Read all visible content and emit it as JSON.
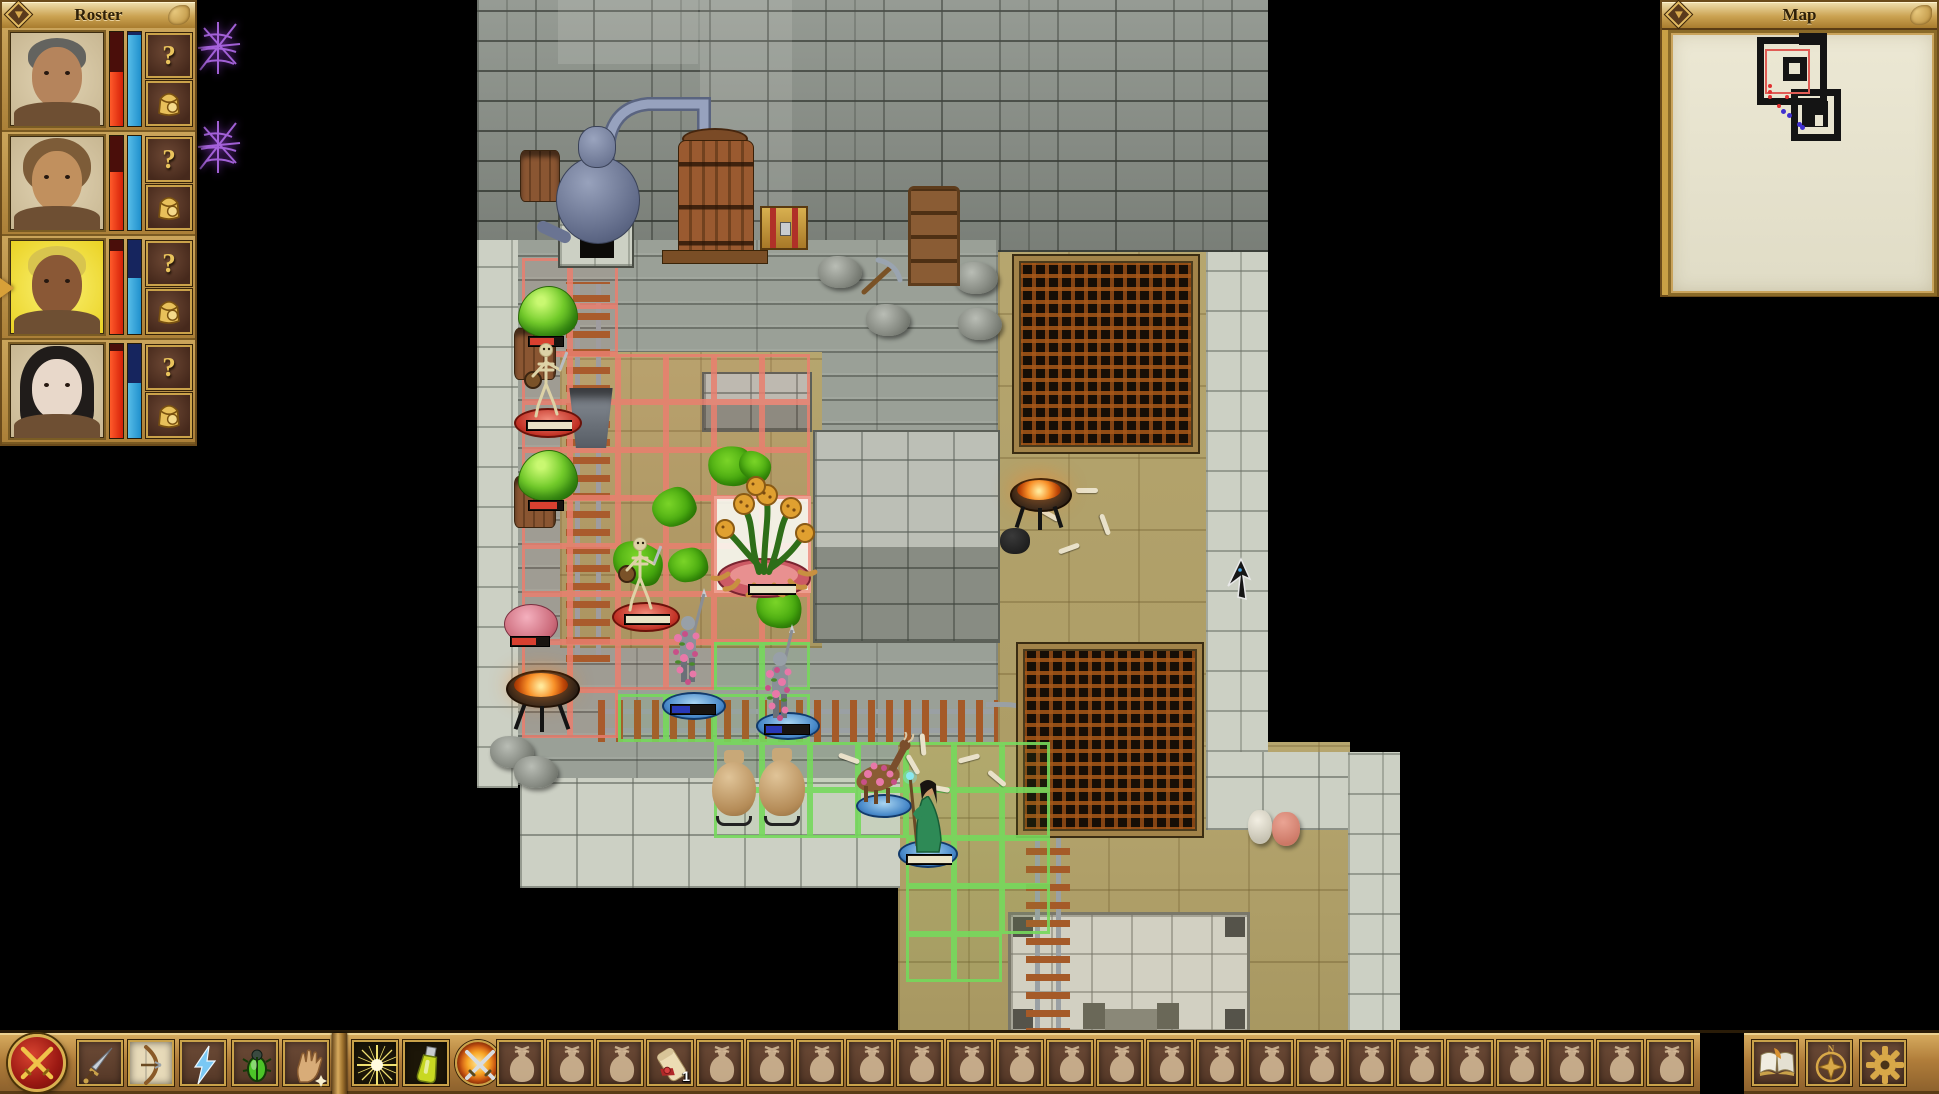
{
  "colors": {
    "accent_gold": "#c9a24a",
    "panel_wood": "#b8924a",
    "hp_red": "#e83416",
    "sp_blue": "#2e9fd6",
    "threat_red": "#e97f6f",
    "move_green": "#76d85c",
    "selected_slot": "#e7dab9"
  },
  "roster": {
    "title": "Roster",
    "collapse_icon": "chevron-down-icon",
    "info_label": "?",
    "inventory_icon": "backpack-icon",
    "members": [
      {
        "id": "member-1",
        "active": false,
        "hp_pct": 57,
        "sp_pct": 97,
        "skin": "#b5845c",
        "hair": "#63635f",
        "hair_style": "short"
      },
      {
        "id": "member-2",
        "active": false,
        "hp_pct": 62,
        "sp_pct": 100,
        "skin": "#c1905e",
        "hair": "#7d5c38",
        "hair_style": "med"
      },
      {
        "id": "member-3",
        "active": true,
        "hp_pct": 88,
        "sp_pct": 60,
        "skin": "#8a5836",
        "hair": "#d8c44e",
        "hair_style": "short"
      },
      {
        "id": "member-4",
        "active": false,
        "hp_pct": 93,
        "sp_pct": 58,
        "skin": "#e8d8ca",
        "hair": "#201c1a",
        "hair_style": "long"
      }
    ]
  },
  "status_effects": [
    {
      "icon": "spiderweb-icon"
    },
    {
      "icon": "spiderweb-icon"
    }
  ],
  "map_panel": {
    "title": "Map",
    "collapse_icon": "chevron-down-icon",
    "red_dots": [
      [
        97,
        51
      ],
      [
        97,
        57
      ],
      [
        97,
        62
      ],
      [
        114,
        62
      ],
      [
        106,
        71
      ]
    ],
    "blue_dots": [
      [
        110,
        76
      ],
      [
        116,
        80
      ],
      [
        126,
        89
      ],
      [
        129,
        92
      ]
    ]
  },
  "toolbar": {
    "combat_button": {
      "icon": "crossed-swords-icon"
    },
    "ability_slots": [
      {
        "icon": "dagger-icon",
        "selected": false
      },
      {
        "icon": "bow-icon",
        "selected": true
      },
      {
        "icon": "lightning-icon",
        "selected": false
      },
      {
        "icon": "scarab-icon",
        "selected": false
      },
      {
        "icon": "hand-icon",
        "selected": false
      }
    ],
    "special_slots": [
      {
        "icon": "starburst-icon"
      },
      {
        "icon": "potion-icon"
      },
      {
        "icon": "melee-attack-icon"
      }
    ],
    "bag_slot_count": 24,
    "bag_items": [
      {
        "slot": 3,
        "icon": "scroll-icon",
        "quantity": "1"
      }
    ],
    "system_buttons": [
      {
        "icon": "journal-icon"
      },
      {
        "icon": "compass-icon",
        "letter": "N"
      },
      {
        "icon": "settings-icon"
      }
    ]
  },
  "scene": {
    "red_cells": [
      [
        522,
        258
      ],
      [
        570,
        258
      ],
      [
        522,
        306
      ],
      [
        570,
        306
      ],
      [
        522,
        354
      ],
      [
        570,
        354
      ],
      [
        618,
        354
      ],
      [
        666,
        354
      ],
      [
        714,
        354
      ],
      [
        762,
        354
      ],
      [
        522,
        402
      ],
      [
        570,
        402
      ],
      [
        618,
        402
      ],
      [
        666,
        402
      ],
      [
        714,
        402
      ],
      [
        762,
        402
      ],
      [
        522,
        450
      ],
      [
        570,
        450
      ],
      [
        618,
        450
      ],
      [
        666,
        450
      ],
      [
        714,
        450
      ],
      [
        762,
        450
      ],
      [
        522,
        498
      ],
      [
        570,
        498
      ],
      [
        618,
        498
      ],
      [
        666,
        498
      ],
      [
        714,
        498
      ],
      [
        762,
        498
      ],
      [
        522,
        546
      ],
      [
        570,
        546
      ],
      [
        618,
        546
      ],
      [
        666,
        546
      ],
      [
        714,
        546
      ],
      [
        762,
        546
      ],
      [
        522,
        594
      ],
      [
        570,
        594
      ],
      [
        618,
        594
      ],
      [
        666,
        594
      ],
      [
        714,
        594
      ],
      [
        762,
        594
      ],
      [
        522,
        642
      ],
      [
        570,
        642
      ],
      [
        618,
        642
      ],
      [
        666,
        642
      ],
      [
        522,
        690
      ],
      [
        570,
        690
      ]
    ],
    "green_cells": [
      [
        714,
        642
      ],
      [
        762,
        642
      ],
      [
        618,
        694
      ],
      [
        666,
        694
      ],
      [
        714,
        694
      ],
      [
        762,
        694
      ],
      [
        714,
        742
      ],
      [
        762,
        742
      ],
      [
        810,
        742
      ],
      [
        858,
        742
      ],
      [
        906,
        742
      ],
      [
        954,
        742
      ],
      [
        1002,
        742
      ],
      [
        714,
        790
      ],
      [
        762,
        790
      ],
      [
        810,
        790
      ],
      [
        858,
        790
      ],
      [
        906,
        790
      ],
      [
        954,
        790
      ],
      [
        1002,
        790
      ],
      [
        906,
        838
      ],
      [
        954,
        838
      ],
      [
        1002,
        838
      ],
      [
        906,
        886
      ],
      [
        954,
        886
      ],
      [
        1002,
        886
      ],
      [
        906,
        934
      ],
      [
        954,
        934
      ]
    ],
    "goo_splats": [
      [
        708,
        446,
        46,
        40,
        10
      ],
      [
        652,
        488,
        44,
        38,
        -15
      ],
      [
        612,
        542,
        52,
        42,
        30
      ],
      [
        668,
        548,
        40,
        34,
        -5
      ],
      [
        756,
        588,
        46,
        40,
        15
      ],
      [
        738,
        452,
        34,
        28,
        40
      ]
    ],
    "bones": [
      [
        838,
        756,
        20
      ],
      [
        866,
        776,
        -35
      ],
      [
        902,
        762,
        60
      ],
      [
        928,
        786,
        10
      ],
      [
        958,
        756,
        -15
      ],
      [
        986,
        776,
        40
      ],
      [
        1038,
        512,
        30
      ],
      [
        1058,
        546,
        -20
      ],
      [
        1094,
        522,
        70
      ],
      [
        1076,
        488,
        0
      ],
      [
        912,
        742,
        85
      ]
    ],
    "rocks": [
      [
        818,
        256
      ],
      [
        954,
        262
      ],
      [
        866,
        304
      ],
      [
        958,
        308
      ],
      [
        490,
        736
      ],
      [
        514,
        756
      ]
    ]
  }
}
